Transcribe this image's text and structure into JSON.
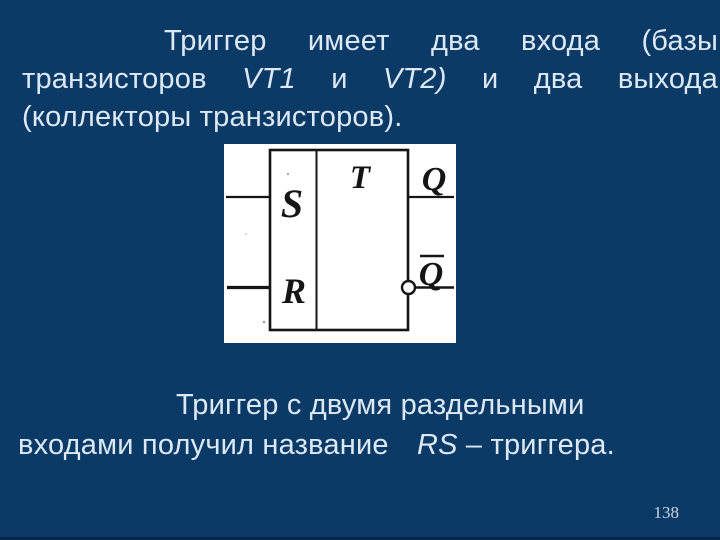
{
  "page": {
    "background_color": "#0c3a66",
    "text_color": "#dce8f4",
    "number": "138"
  },
  "top_paragraph": {
    "line1": "Триггер имеет два входа (базы",
    "line2": {
      "pre": "транзисторов ",
      "vt1": "VT1",
      "mid": " и ",
      "vt2": "VT2)",
      "post": " и два выхода"
    },
    "line3": "(коллекторы транзисторов)."
  },
  "bottom_paragraph": {
    "line1": "Триггер с двумя раздельными",
    "line2": {
      "pre": "входами получил название ",
      "rs": "RS",
      "post": " – триггера."
    }
  },
  "diagram": {
    "type_label": "T",
    "set_input_label": "S",
    "reset_input_label": "R",
    "output_label": "Q",
    "inverted_output_label": "Q",
    "ink_color": "#151515",
    "paper_color": "#ffffff"
  }
}
